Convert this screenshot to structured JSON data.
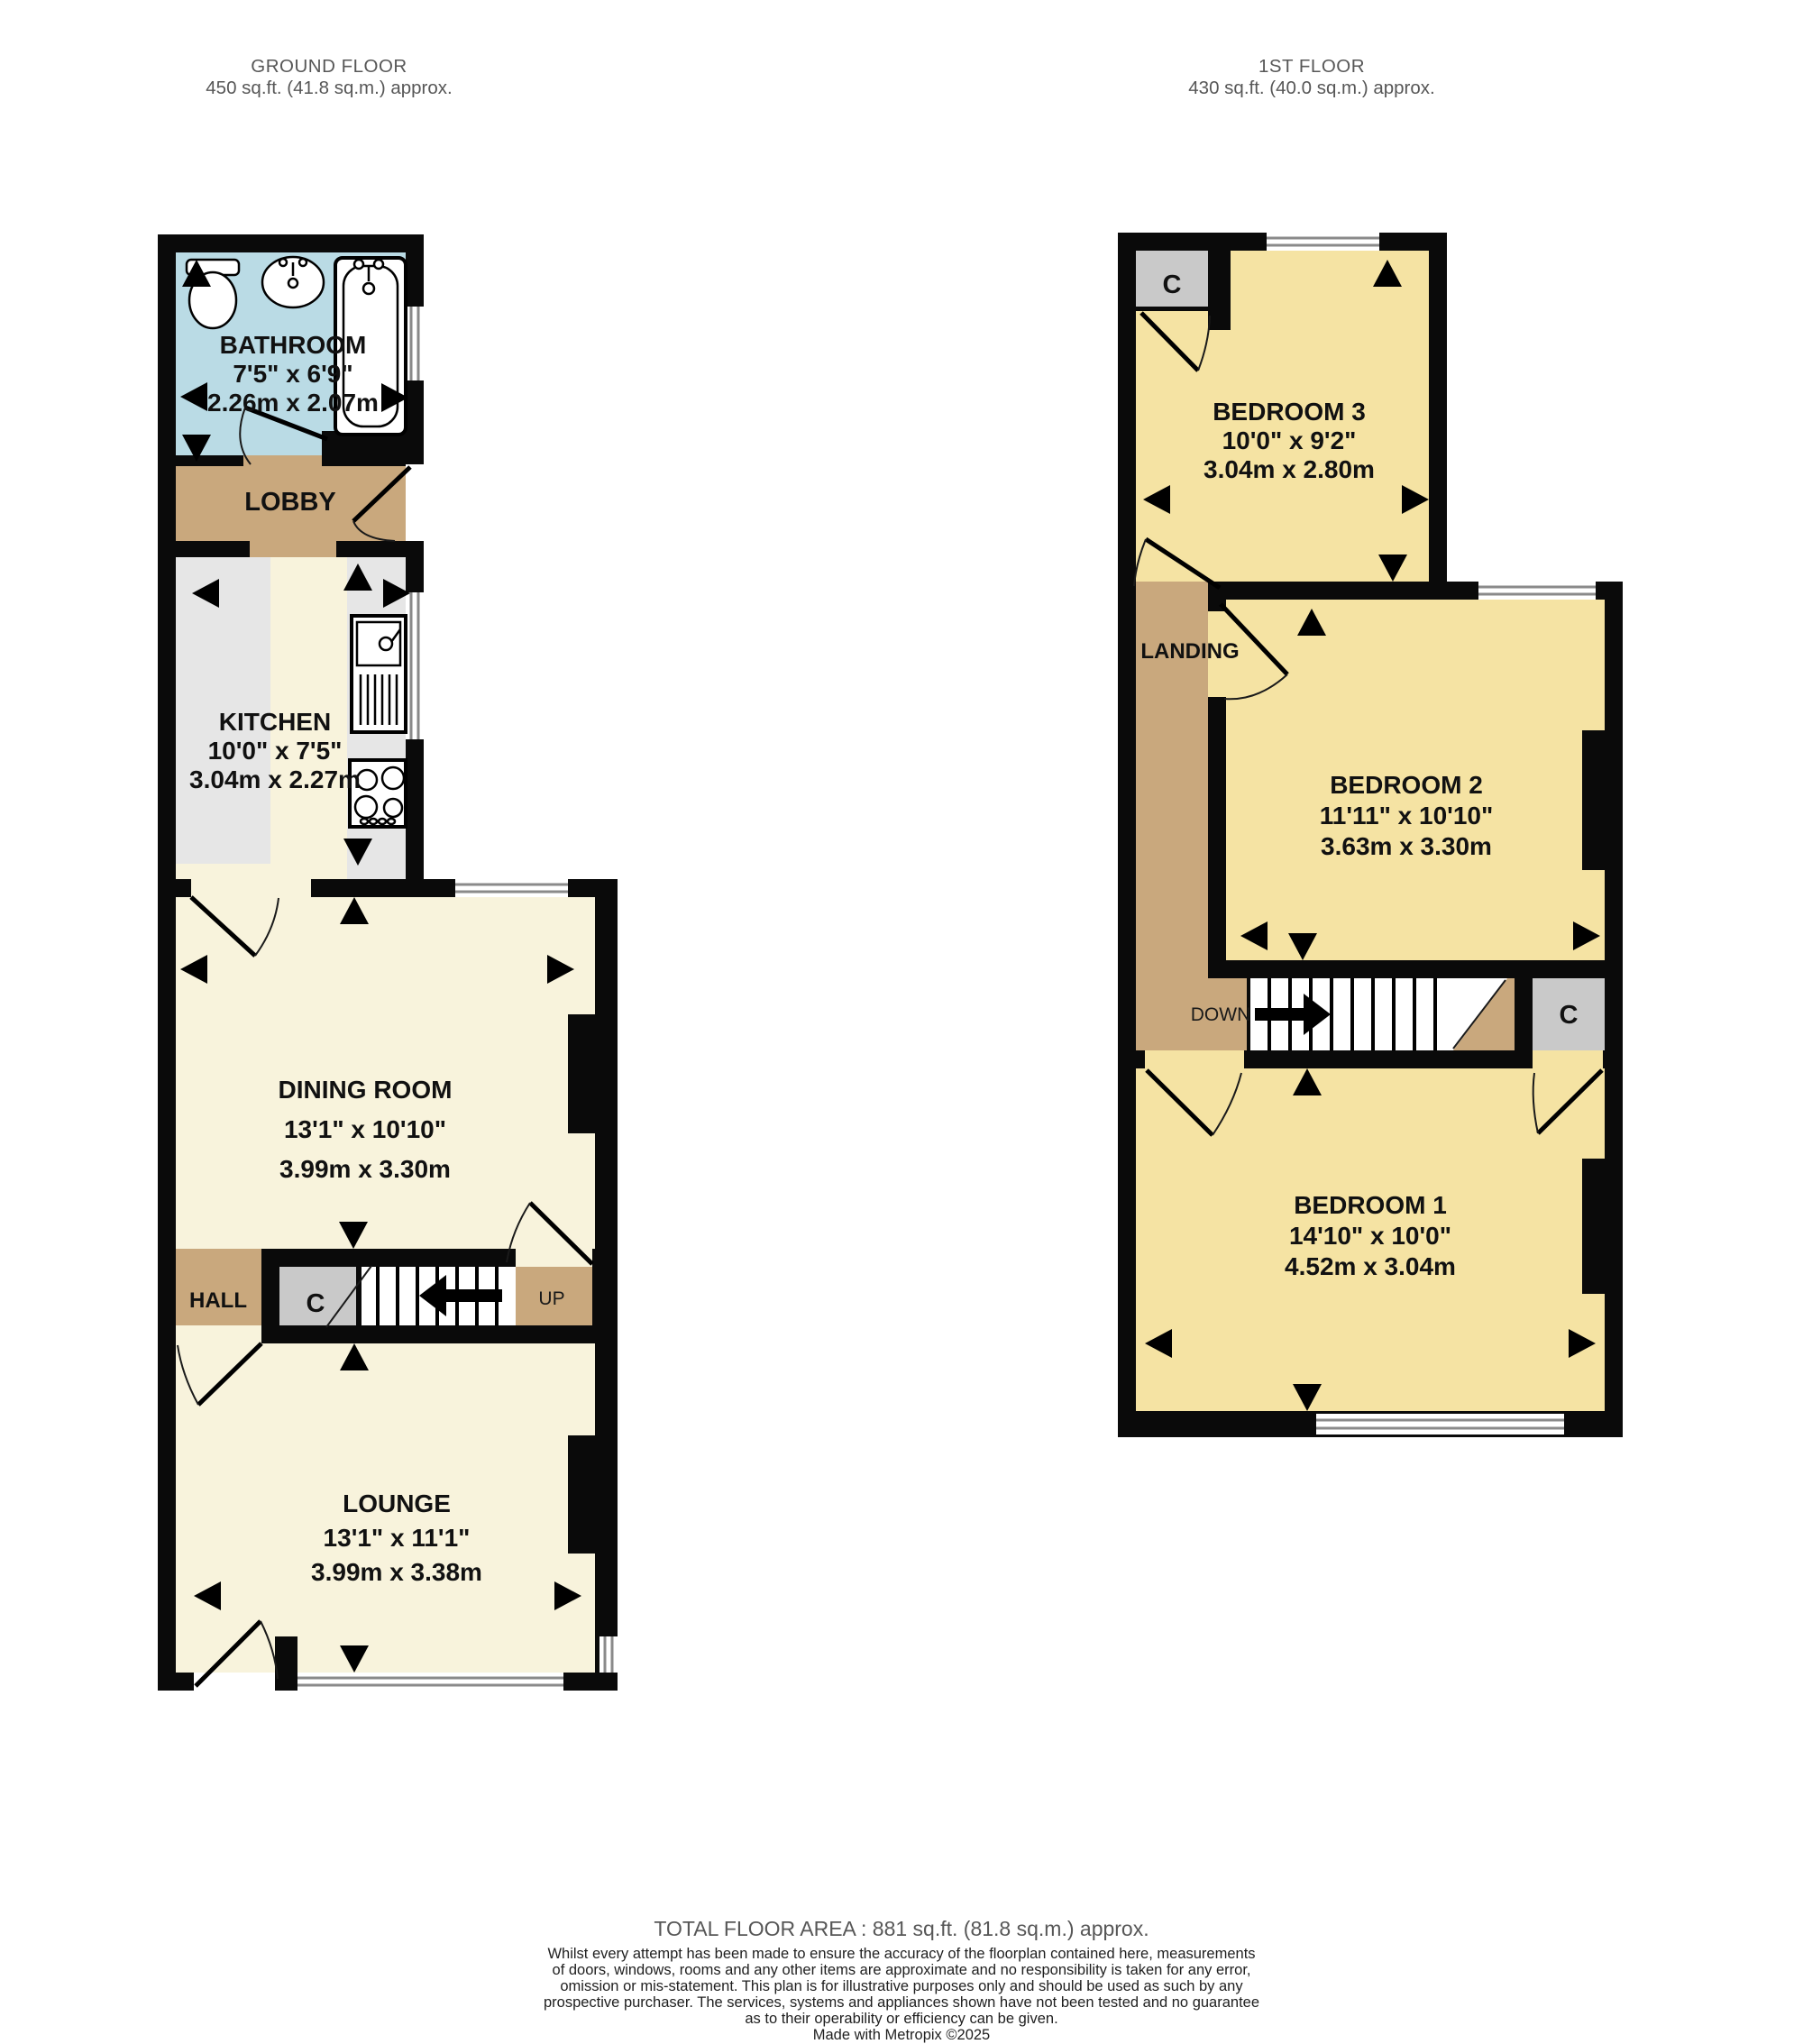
{
  "gf": {
    "title": "GROUND FLOOR",
    "area": "450 sq.ft. (41.8 sq.m.) approx.",
    "rooms": {
      "bathroom": {
        "name": "BATHROOM",
        "imperial": "7'5\"  x 6'9\"",
        "metric": "2.26m  x 2.07m"
      },
      "lobby": {
        "name": "LOBBY"
      },
      "kitchen": {
        "name": "KITCHEN",
        "imperial": "10'0\"  x 7'5\"",
        "metric": "3.04m  x 2.27m"
      },
      "dining": {
        "name": "DINING ROOM",
        "imperial": "13'1\"  x 10'10\"",
        "metric": "3.99m  x 3.30m"
      },
      "hall": {
        "name": "HALL"
      },
      "lounge": {
        "name": "LOUNGE",
        "imperial": "13'1\"  x 11'1\"",
        "metric": "3.99m  x 3.38m"
      }
    },
    "labels": {
      "closet": "C",
      "stairs": "UP"
    }
  },
  "ff": {
    "title": "1ST FLOOR",
    "area": "430 sq.ft. (40.0 sq.m.) approx.",
    "rooms": {
      "bedroom3": {
        "name": "BEDROOM 3",
        "imperial": "10'0\"  x 9'2\"",
        "metric": "3.04m  x 2.80m"
      },
      "landing": {
        "name": "LANDING"
      },
      "bedroom2": {
        "name": "BEDROOM 2",
        "imperial": "11'11\"  x 10'10\"",
        "metric": "3.63m  x 3.30m"
      },
      "bedroom1": {
        "name": "BEDROOM 1",
        "imperial": "14'10\"  x 10'0\"",
        "metric": "4.52m  x 3.04m"
      }
    },
    "labels": {
      "closet_top": "C",
      "closet_right": "C",
      "stairs": "DOWN"
    }
  },
  "footer": {
    "total": "TOTAL FLOOR AREA : 881 sq.ft. (81.8 sq.m.) approx.",
    "disclaimer": [
      "Whilst every attempt has been made to ensure the accuracy of the floorplan contained here, measurements",
      "of doors, windows, rooms and any other items are approximate and no responsibility is taken for any error,",
      "omission or mis-statement. This plan is for illustrative purposes only and should be used as such by any",
      "prospective purchaser. The services, systems and appliances shown have not been tested and no guarantee",
      "as to their operability or efficiency can be given."
    ],
    "credit": "Made with Metropix ©2025"
  },
  "colors": {
    "wall": "#0a0a0a",
    "cream": "#f8f3dc",
    "yellow": "#f5e3a3",
    "tan": "#c9a87d",
    "blue": "#badbe5",
    "closet": "#c9c9c9",
    "counter": "#e6e6e6",
    "winline": "#8a8a8a",
    "heading": "#575757",
    "text": "#111111"
  }
}
